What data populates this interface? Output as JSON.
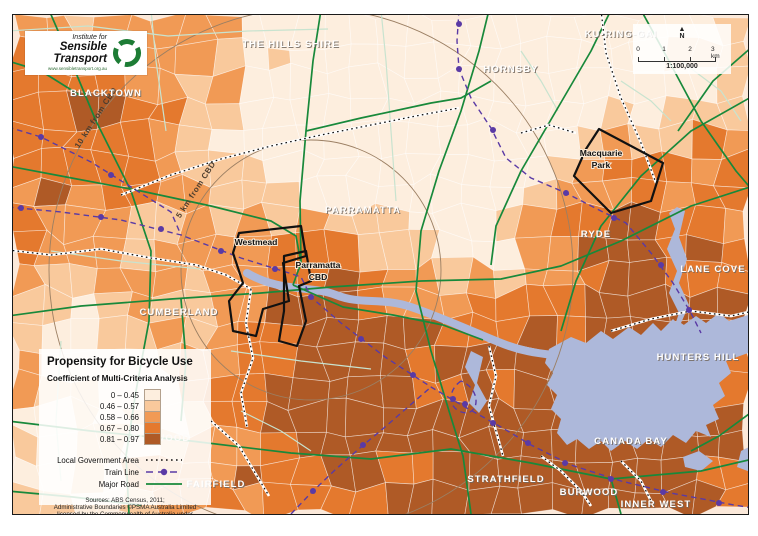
{
  "branding": {
    "line1": "Institute for",
    "line2": "Sensible Transport",
    "url": "www.sensibletransport.org.au"
  },
  "scale": {
    "north": "N",
    "north_arrow": "▲",
    "ticks": [
      "0",
      "1",
      "2",
      "3 km"
    ],
    "ratio": "1:100,000"
  },
  "legend": {
    "title": "Propensity for Bicycle Use",
    "subtitle": "Coefficient of Multi-Criteria Analysis",
    "classes": [
      {
        "label": "0 – 0.45",
        "color": "#fdeede"
      },
      {
        "label": "0.46 – 0.57",
        "color": "#f9c99c"
      },
      {
        "label": "0.58 – 0.66",
        "color": "#f19a55"
      },
      {
        "label": "0.67 – 0.80",
        "color": "#e4792e"
      },
      {
        "label": "0.81 – 0.97",
        "color": "#af5a26"
      }
    ],
    "lines": [
      {
        "label": "Local Government Area",
        "type": "lga"
      },
      {
        "label": "Train Line",
        "type": "train"
      },
      {
        "label": "Major Road",
        "type": "road"
      }
    ],
    "sources": [
      "Sources: ABS Census, 2011;",
      "Administrative Boundaries ©PSMA Australia Limited",
      "licensed by the Commonwealth of Australia under Creative",
      "Commons Attribution 4.0 International licence (CC BY 4.0)."
    ]
  },
  "map": {
    "colors": {
      "water": "#adb8da",
      "major_road": "#18893b",
      "minor_road": "#c8e3cf",
      "train": "#5a3aa5",
      "radius_circle": "#9b7f63",
      "highlight": "#111111"
    },
    "region_labels": [
      {
        "text": "BLACKTOWN",
        "x": 93,
        "y": 81
      },
      {
        "text": "THE HILLS SHIRE",
        "x": 278,
        "y": 32
      },
      {
        "text": "HORNSBY",
        "x": 498,
        "y": 57
      },
      {
        "text": "KU-RING-GAI",
        "x": 608,
        "y": 22
      },
      {
        "text": "PARRAMATTA",
        "x": 350,
        "y": 198
      },
      {
        "text": "RYDE",
        "x": 583,
        "y": 222
      },
      {
        "text": "LANE COVE",
        "x": 700,
        "y": 257
      },
      {
        "text": "CUMBERLAND",
        "x": 166,
        "y": 300
      },
      {
        "text": "HUNTERS HILL",
        "x": 685,
        "y": 345
      },
      {
        "text": "CANADA BAY",
        "x": 618,
        "y": 429
      },
      {
        "text": "STRATHFIELD",
        "x": 493,
        "y": 467
      },
      {
        "text": "BURWOOD",
        "x": 576,
        "y": 480
      },
      {
        "text": "INNER WEST",
        "x": 643,
        "y": 492
      },
      {
        "text": "FAIRFIELD",
        "x": 203,
        "y": 472
      }
    ],
    "place_labels": [
      {
        "lines": [
          "Westmead"
        ],
        "x": 243,
        "y": 230
      },
      {
        "lines": [
          "Parramatta",
          "CBD"
        ],
        "x": 305,
        "y": 253
      },
      {
        "lines": [
          "Macquarie",
          "Park"
        ],
        "x": 588,
        "y": 141
      }
    ],
    "radius_labels": [
      {
        "text": "5 km from CBD",
        "x": 185,
        "y": 176,
        "rot": -57
      },
      {
        "text": "10 km from CBD",
        "x": 85,
        "y": 104,
        "rot": -57
      }
    ],
    "ghost_label": {
      "text": "BURWOOD",
      "x": 148,
      "y": 426
    }
  }
}
